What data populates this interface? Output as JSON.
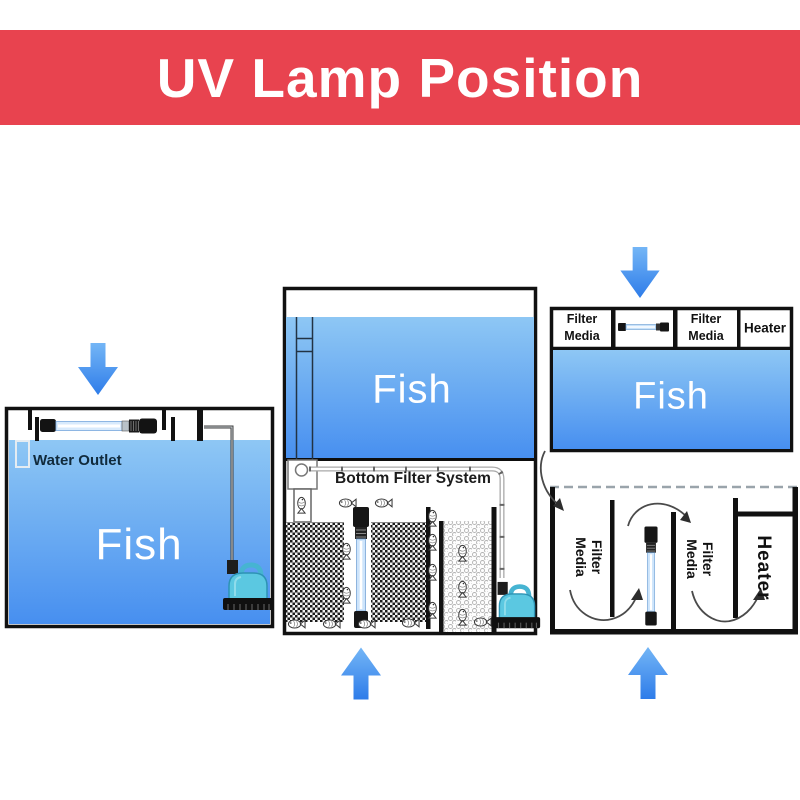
{
  "banner": {
    "title": "UV Lamp Position"
  },
  "colors": {
    "banner_red": "#e8434f",
    "water_top": "#8ec7f4",
    "water_bottom": "#478ff0",
    "arrow_blue_top": "#74b6f6",
    "arrow_blue_bottom": "#2e7ce9",
    "pump_cyan": "#5bc8e1",
    "uv_tube_blue": "#cde4fb"
  },
  "tank1": {
    "fish_label": "Fish",
    "water_outlet_label": "Water Outlet"
  },
  "tank2": {
    "fish_label": "Fish",
    "system_label": "Bottom Filter System"
  },
  "tank3": {
    "fish_label": "Fish",
    "compartments": {
      "filter_media_a": {
        "line1": "Filter",
        "line2": "Media"
      },
      "filter_media_b": {
        "line1": "Filter",
        "line2": "Media"
      },
      "heater": "Heater"
    },
    "sump": {
      "filter_media_a": {
        "line1": "Filter",
        "line2": "Media"
      },
      "filter_media_b": {
        "line1": "Filter",
        "line2": "Media"
      },
      "heater": "Heater"
    }
  }
}
